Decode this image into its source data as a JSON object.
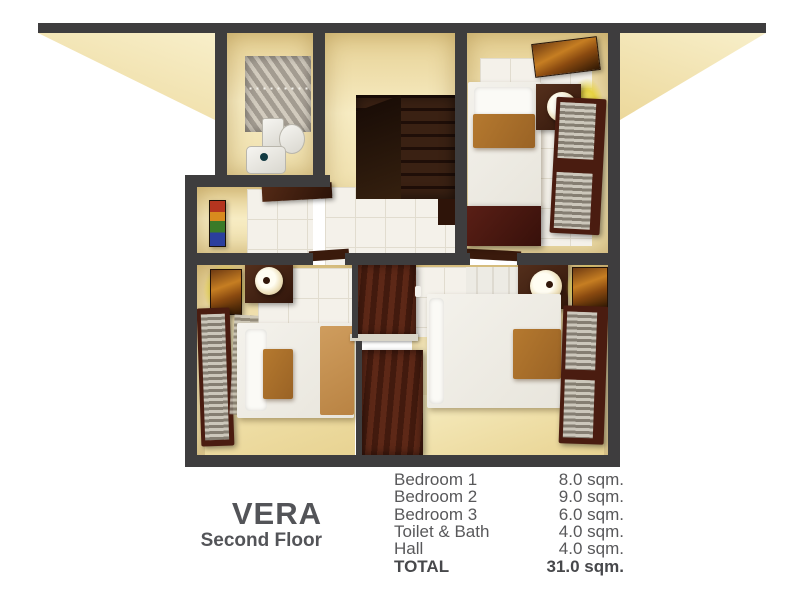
{
  "title": {
    "name": "VERA",
    "subtitle": "Second Floor"
  },
  "legend": {
    "rows": [
      {
        "label": "Bedroom 1",
        "value": "8.0 sqm."
      },
      {
        "label": "Bedroom 2",
        "value": "9.0 sqm."
      },
      {
        "label": "Bedroom 3",
        "value": "6.0 sqm."
      },
      {
        "label": "Toilet & Bath",
        "value": "4.0 sqm."
      },
      {
        "label": "Hall",
        "value": "4.0 sqm."
      },
      {
        "label": "TOTAL",
        "value": "31.0 sqm."
      }
    ]
  },
  "colors": {
    "wall": "#3e3d3e",
    "roof_beige": "#f3e6b8",
    "room_wall_beige": "#ecd9a2",
    "floor_tile": "#f4f1ea",
    "floor_beige": "#efdfab",
    "wood_dark": "#2e1409",
    "wood_maroon": "#4a1c10",
    "lamp_glow": "#ead94f",
    "text_gray": "#58585a"
  }
}
